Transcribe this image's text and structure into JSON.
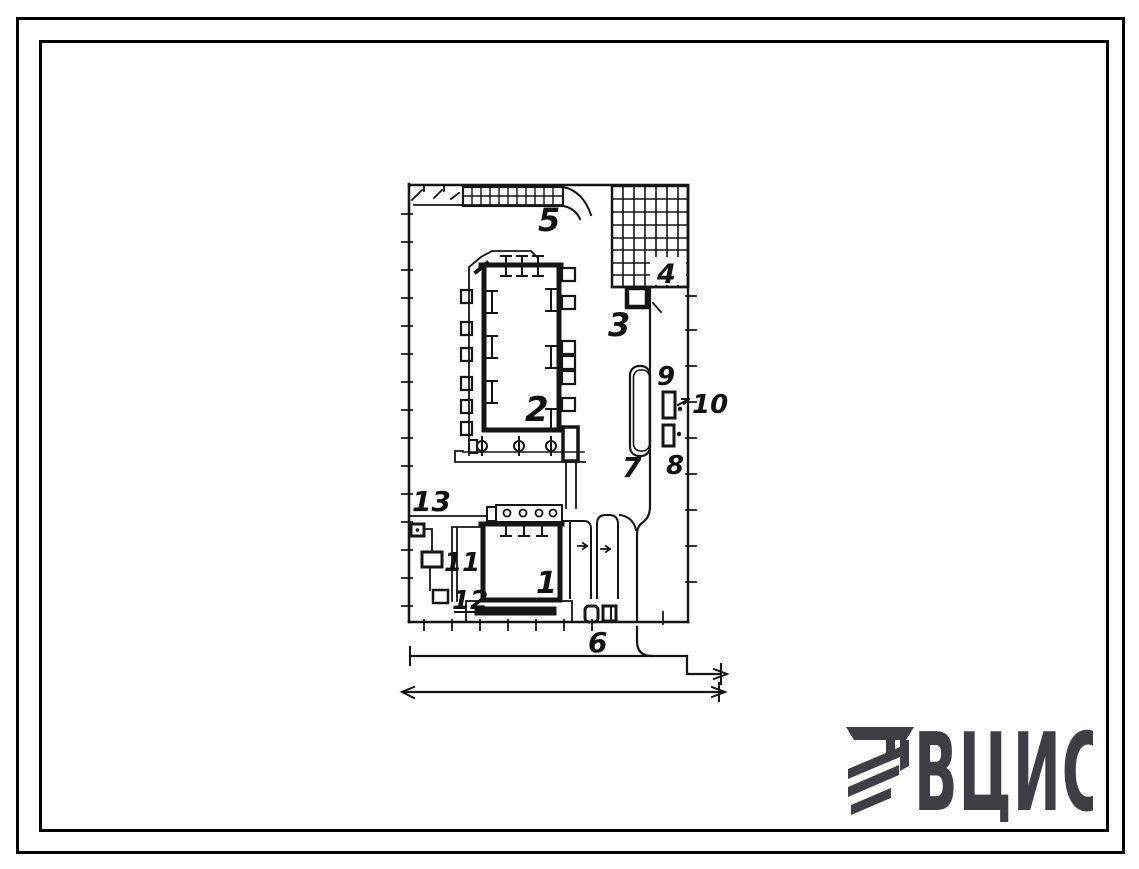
{
  "plan": {
    "labels": {
      "l1": "1",
      "l2": "2",
      "l3": "3",
      "l4": "4",
      "l5": "5",
      "l6": "6",
      "l7": "7",
      "l8": "8",
      "l9": "9",
      "l10": "10",
      "l11": "11",
      "l12": "12",
      "l13": "13"
    }
  },
  "logo": {
    "text": "ВЦИС",
    "color": "#3e3e44"
  },
  "colors": {
    "ink": "#151515",
    "paper": "#ffffff",
    "frame": "#000000"
  }
}
